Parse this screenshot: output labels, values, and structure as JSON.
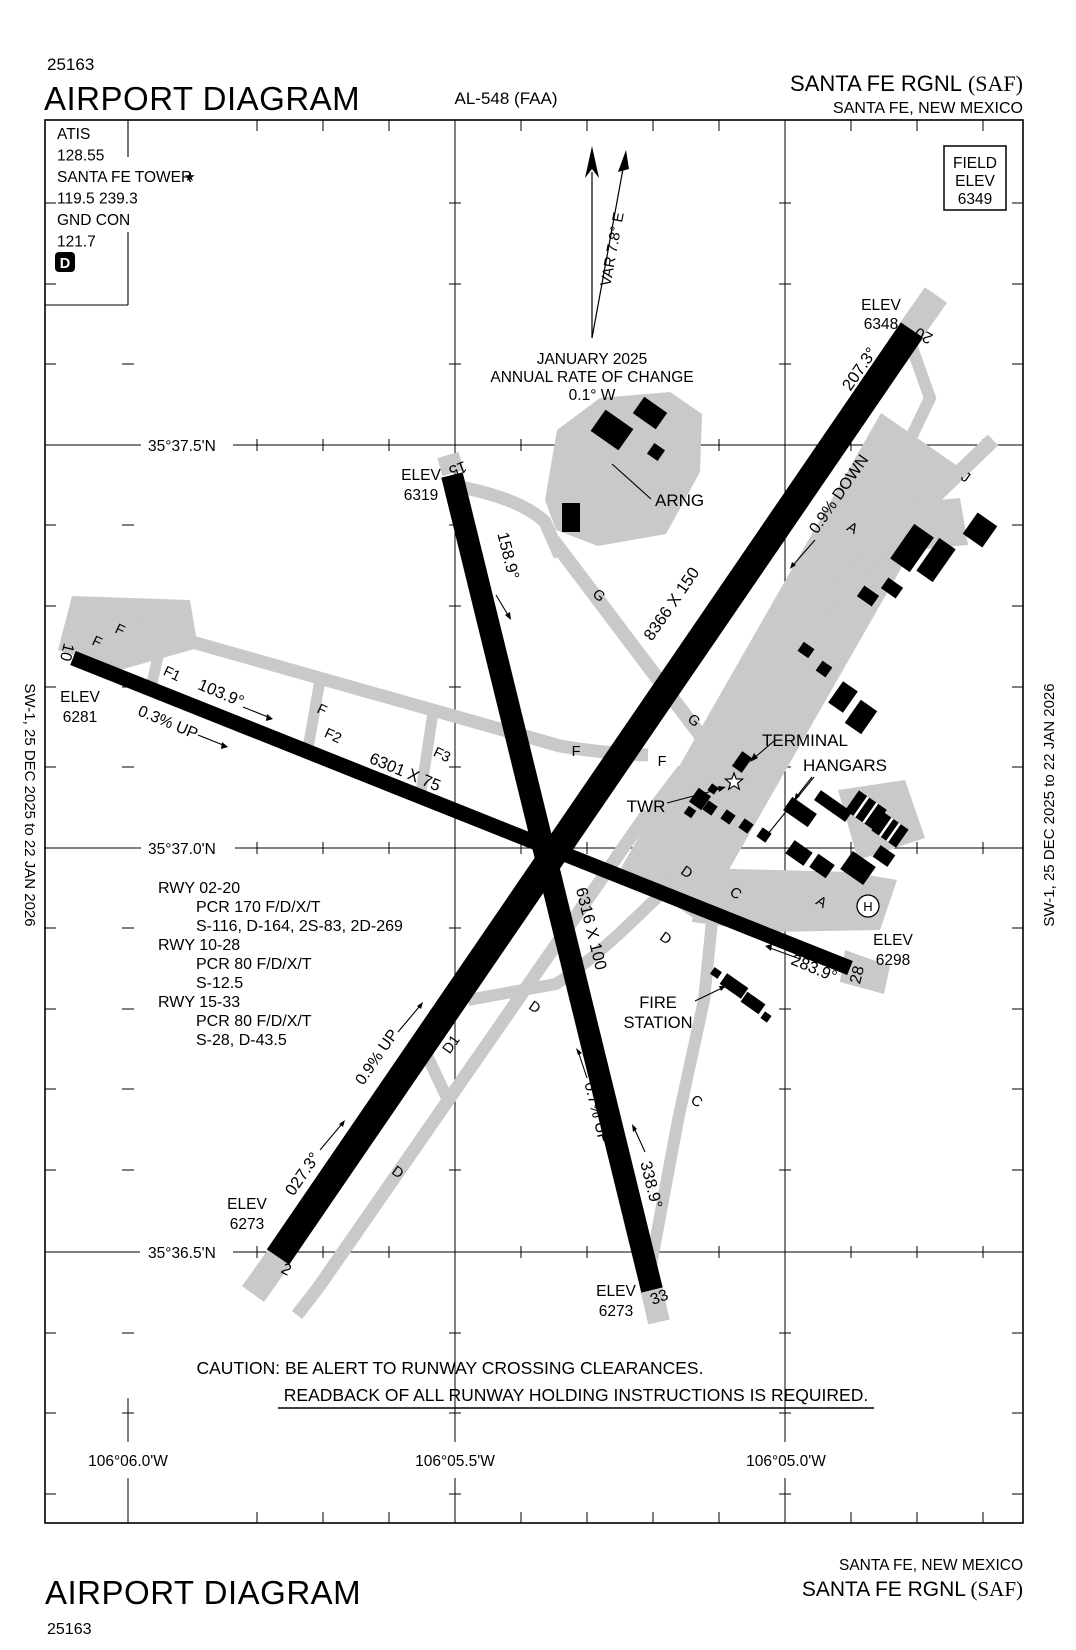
{
  "header": {
    "chart_code": "25163",
    "title": "AIRPORT DIAGRAM",
    "procedure_id": "AL-548 (FAA)",
    "airport_name": "SANTA FE RGNL",
    "airport_icao": "(SAF)",
    "city": "SANTA FE, NEW MEXICO"
  },
  "footer": {
    "title": "AIRPORT DIAGRAM",
    "chart_code": "25163",
    "airport_name": "SANTA FE RGNL",
    "airport_icao": "(SAF)",
    "city": "SANTA FE, NEW MEXICO"
  },
  "margins": {
    "left": "SW-1,  25 DEC 2025  to  22 JAN 2026",
    "right": "SW-1,  25 DEC 2025  to  22 JAN 2026"
  },
  "comm": {
    "atis_label": "ATIS",
    "atis_freq": "128.55",
    "tower_label": "SANTA FE TOWER",
    "tower_star": "★",
    "tower_freqs": "119.5  239.3",
    "ground_label": "GND CON",
    "ground_freq": "121.7",
    "clearance_symbol": "D"
  },
  "field_elev": {
    "line1": "FIELD",
    "line2": "ELEV",
    "value": "6349"
  },
  "north": {
    "variation": "VAR 7.8° E",
    "month": "JANUARY 2025",
    "rate_label": "ANNUAL RATE OF CHANGE",
    "rate_value": "0.1° W"
  },
  "grid": {
    "lat": [
      "35°37.5'N",
      "35°37.0'N",
      "35°36.5'N"
    ],
    "lon": [
      "106°06.0'W",
      "106°05.5'W",
      "106°05.0'W"
    ]
  },
  "elev_label": "ELEV",
  "runways": {
    "rwy0220": {
      "num_low": "2",
      "num_high": "20",
      "dims": "8366 X 150",
      "hdg_low": "027.3°",
      "hdg_high": "207.3°",
      "slope_low": "0.9% UP",
      "slope_high": "0.9% DOWN",
      "elev_low": "6273",
      "elev_high": "6348"
    },
    "rwy1028": {
      "num_low": "10",
      "num_high": "28",
      "dims": "6301 X 75",
      "hdg_low": "103.9°",
      "hdg_high": "283.9°",
      "slope_low": "0.3% UP",
      "elev_low": "6281",
      "elev_high": "6298"
    },
    "rwy1533": {
      "num_low": "15",
      "num_high": "33",
      "dims": "6316 X 100",
      "hdg_low": "158.9°",
      "hdg_high": "338.9°",
      "slope_high": "0.7% UP",
      "elev_low": "6319",
      "elev_high": "6273"
    }
  },
  "rwy_info": [
    {
      "name": "RWY 02-20",
      "lines": [
        "PCR 170 F/D/X/T",
        "S-116, D-164, 2S-83, 2D-269"
      ]
    },
    {
      "name": "RWY 10-28",
      "lines": [
        "PCR 80 F/D/X/T",
        "S-12.5"
      ]
    },
    {
      "name": "RWY 15-33",
      "lines": [
        "PCR 80 F/D/X/T",
        "S-28, D-43.5"
      ]
    }
  ],
  "caution": {
    "line1": "CAUTION: BE ALERT TO RUNWAY CROSSING CLEARANCES.",
    "line2": "READBACK OF ALL RUNWAY HOLDING INSTRUCTIONS IS REQUIRED."
  },
  "features": {
    "arng": "ARNG",
    "terminal": "TERMINAL",
    "hangars": "HANGARS",
    "tower": "TWR",
    "fire_line1": "FIRE",
    "fire_line2": "STATION",
    "helipad": "H"
  },
  "taxiways": {
    "a": "A",
    "c": "C",
    "d": "D",
    "d1": "D1",
    "f": "F",
    "f1": "F1",
    "f2": "F2",
    "f3": "F3",
    "g": "G",
    "j": "J"
  },
  "colors": {
    "pavement_gray": "#c9c9c9",
    "ink": "#000000"
  }
}
